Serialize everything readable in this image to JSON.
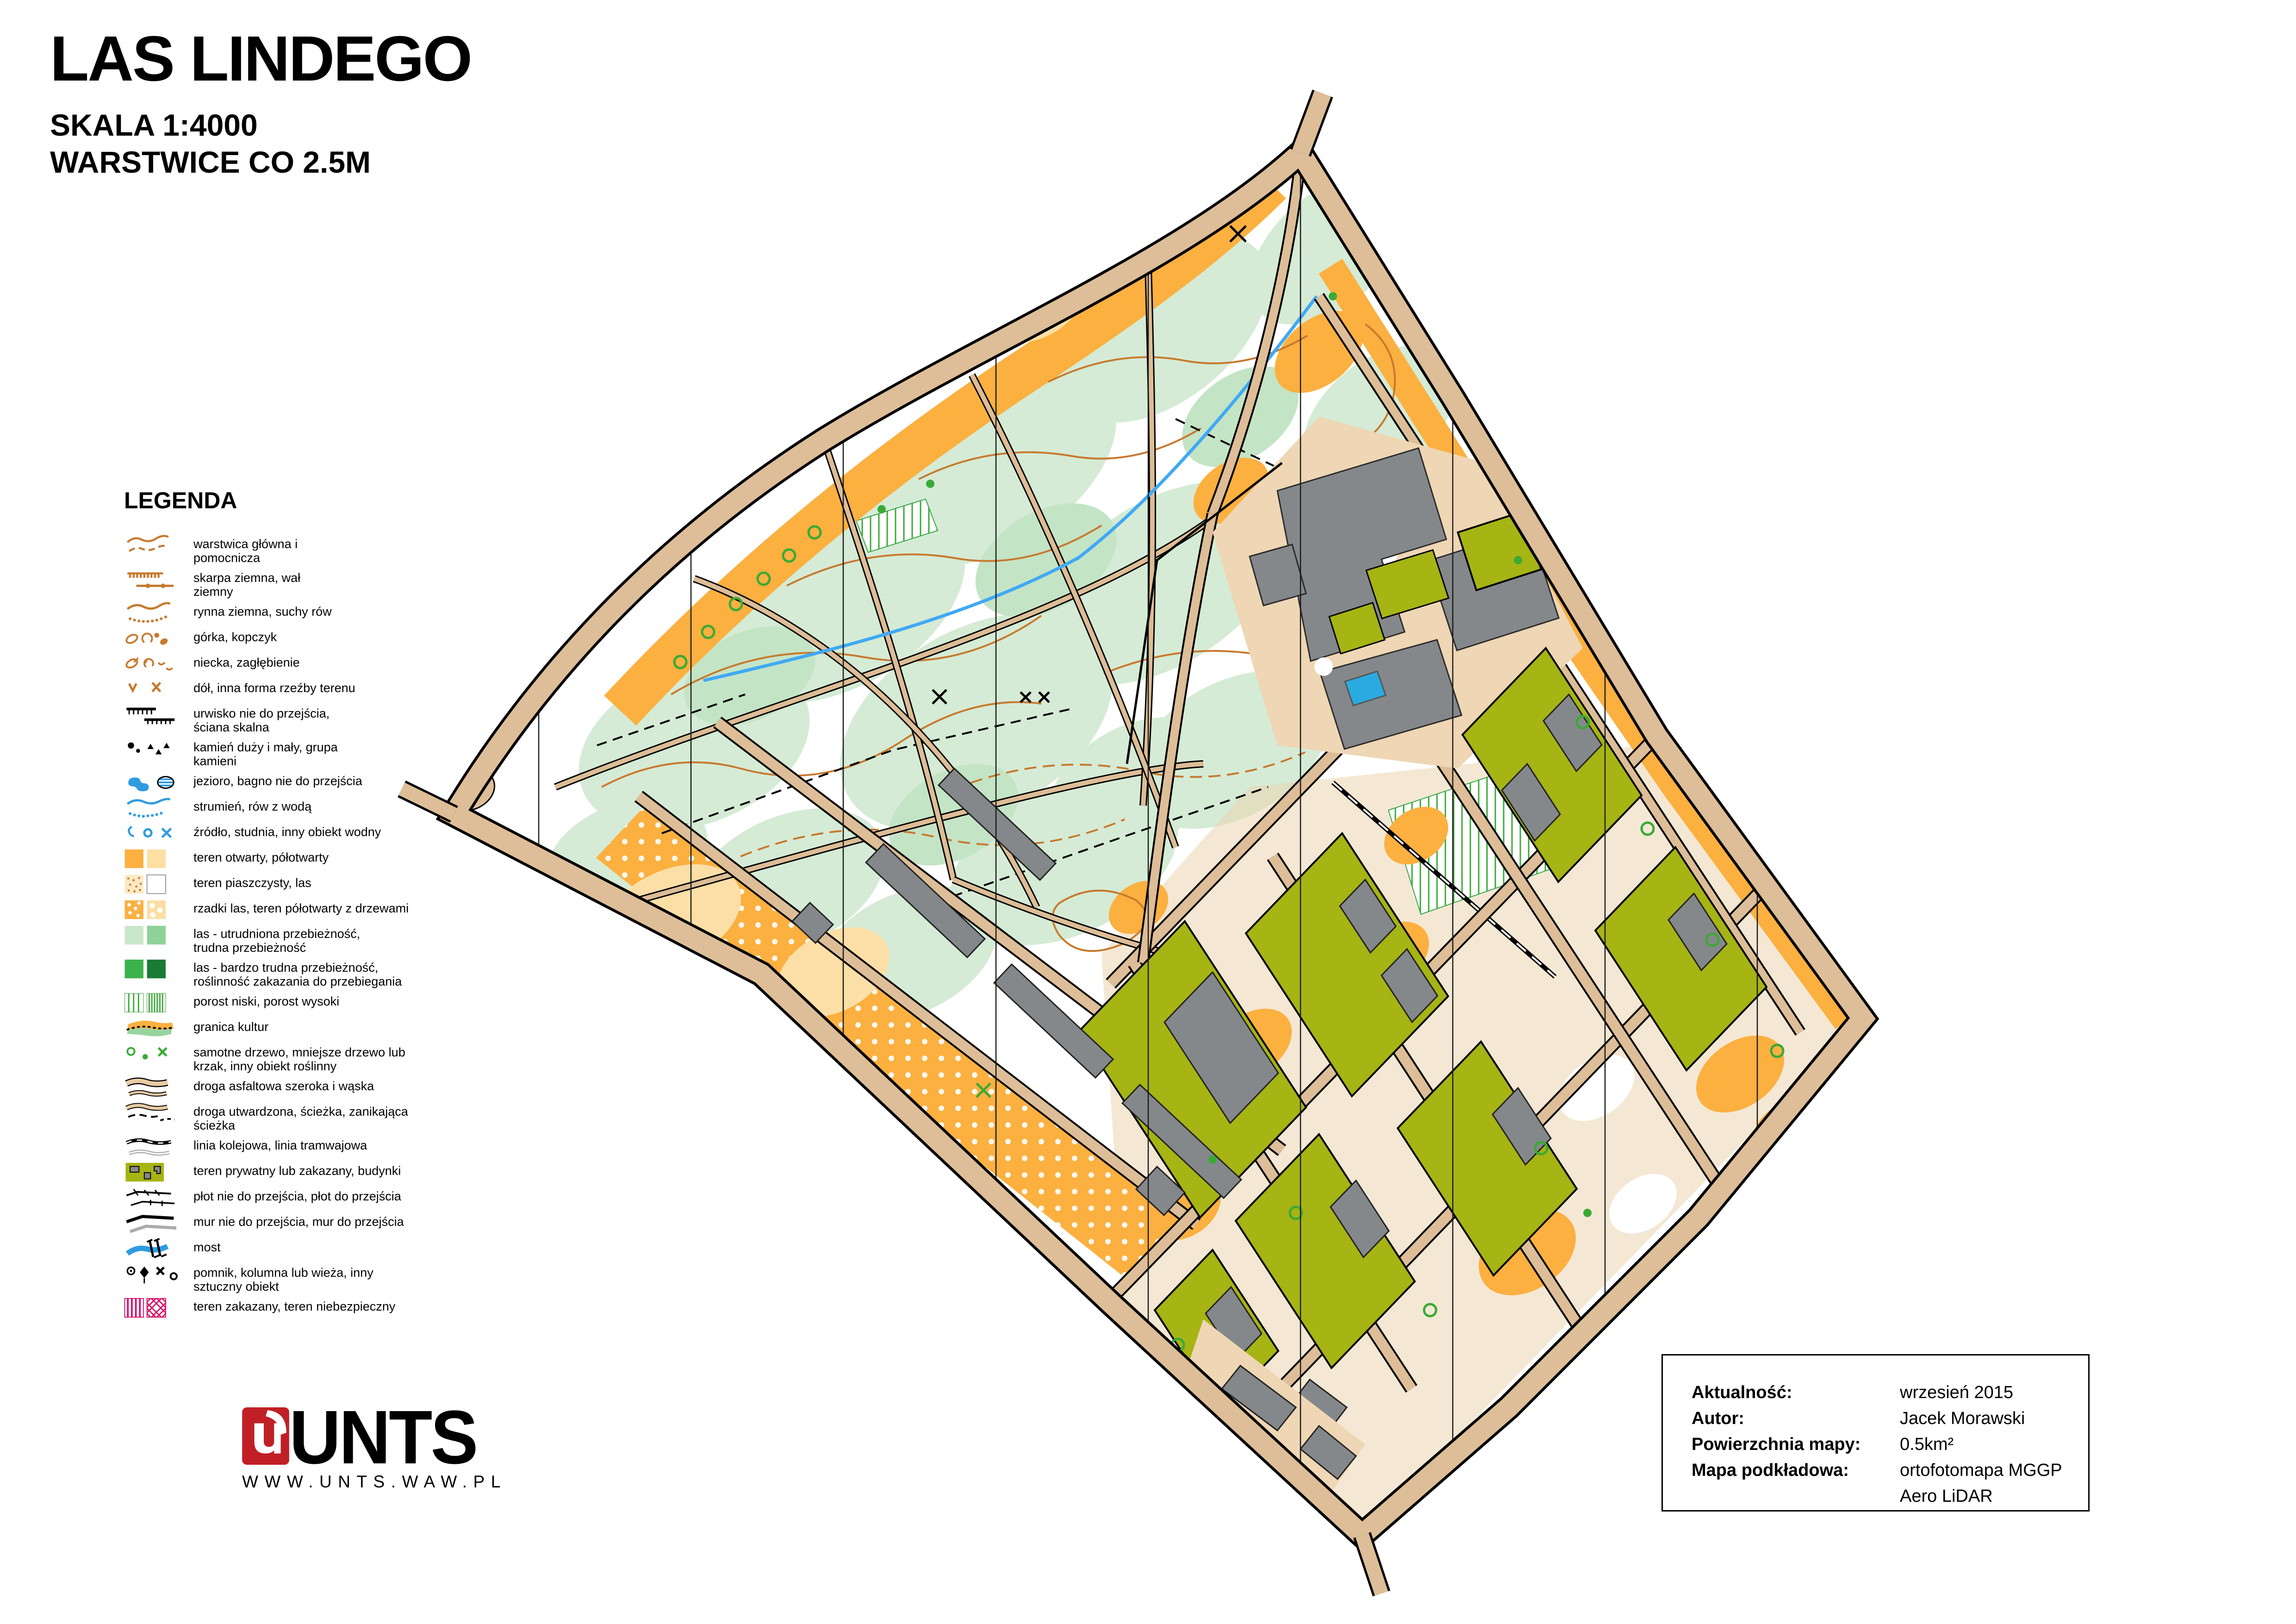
{
  "title": {
    "name": "LAS LINDEGO",
    "scale": "SKALA 1:4000",
    "contours": "WARSTWICE CO 2.5M"
  },
  "legend": {
    "heading": "LEGENDA",
    "items": [
      {
        "icon": "contour-lines",
        "label": "warstwica główna i\npomocnicza"
      },
      {
        "icon": "earth-bank",
        "label": "skarpa ziemna, wał\nziemny"
      },
      {
        "icon": "erosion-gully",
        "label": "rynna ziemna, suchy rów"
      },
      {
        "icon": "knoll",
        "label": "górka, kopczyk"
      },
      {
        "icon": "depression",
        "label": "niecka, zagłębienie"
      },
      {
        "icon": "pit",
        "label": "dół, inna forma rzeźby terenu"
      },
      {
        "icon": "impassable-cliff",
        "label": "urwisko nie do przejścia,\nściana skalna"
      },
      {
        "icon": "boulders",
        "label": "kamień duży i mały, grupa\nkamieni"
      },
      {
        "icon": "lake-marsh",
        "label": "jezioro, bagno nie do przejścia"
      },
      {
        "icon": "stream",
        "label": "strumień, rów z wodą"
      },
      {
        "icon": "water-object",
        "label": "źródło, studnia, inny obiekt wodny"
      },
      {
        "icon": "open-land",
        "label": "teren otwarty, półotwarty"
      },
      {
        "icon": "sandy-ground",
        "label": "teren piaszczysty, las"
      },
      {
        "icon": "scattered-trees",
        "label": "rzadki las, teren półotwarty z drzewami"
      },
      {
        "icon": "forest-slow",
        "label": "las - utrudniona przebieżność,\ntrudna przebieżność"
      },
      {
        "icon": "forest-fight",
        "label": "las - bardzo trudna przebieżność,\nroślinność zakazania do przebiegania"
      },
      {
        "icon": "undergrowth",
        "label": "porost niski, porost wysoki"
      },
      {
        "icon": "cultivation-boundary",
        "label": "granica kultur"
      },
      {
        "icon": "tree-bush",
        "label": "samotne drzewo, mniejsze drzewo lub\nkrzak, inny obiekt roślinny"
      },
      {
        "icon": "paved-road",
        "label": "droga asfaltowa szeroka i wąska"
      },
      {
        "icon": "dirt-path",
        "label": "droga utwardzona, ścieżka, zanikająca\nścieżka"
      },
      {
        "icon": "railway",
        "label": "linia kolejowa, linia tramwajowa"
      },
      {
        "icon": "private-area",
        "label": "teren prywatny lub zakazany, budynki"
      },
      {
        "icon": "fence",
        "label": "płot nie do przejścia, płot do przejścia"
      },
      {
        "icon": "wall",
        "label": "mur nie do przejścia, mur do przejścia"
      },
      {
        "icon": "bridge",
        "label": "most"
      },
      {
        "icon": "monument",
        "label": "pomnik, kolumna lub wieża, inny\nsztuczny obiekt"
      },
      {
        "icon": "forbidden-area",
        "label": "teren zakazany, teren niebezpieczny"
      }
    ]
  },
  "info_box": {
    "rows": [
      {
        "label": "Aktualność:",
        "value": "wrzesień 2015"
      },
      {
        "label": "Autor:",
        "value": "Jacek Morawski"
      },
      {
        "label": "Powierzchnia mapy:",
        "value": "0.5km²"
      },
      {
        "label": "Mapa podkładowa:",
        "value": "ortofotomapa MGGP Aero LiDAR"
      }
    ]
  },
  "logo": {
    "brand": "UNTS",
    "url": "WWW.UNTS.WAW.PL"
  },
  "colors": {
    "logo_red": "#C11F26",
    "contour_orange": "#C8792E",
    "open_orange": "#FBB040",
    "forest_mint": "#D5EBD5",
    "private_olive": "#A6B414",
    "building_gray": "#85888B",
    "water_blue": "#2F9CE0",
    "forbidden_magenta": "#D4146A",
    "road_tan": "#DDBE98"
  }
}
